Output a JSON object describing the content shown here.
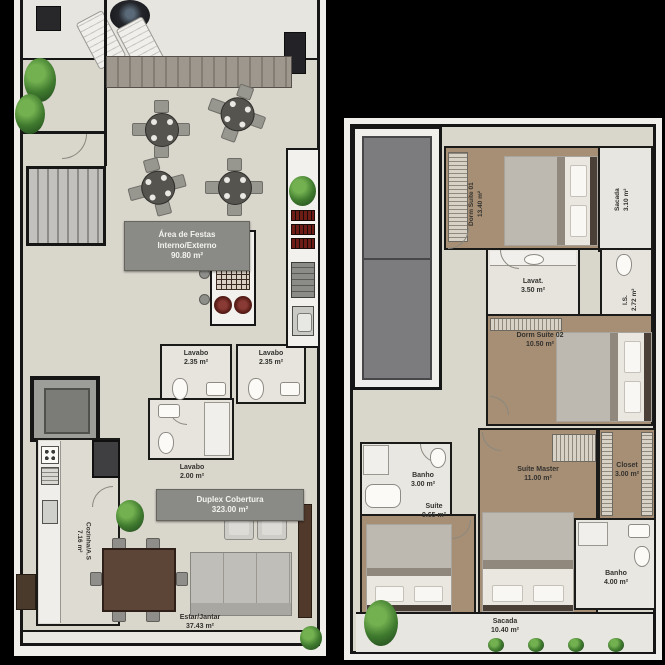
{
  "colors": {
    "background": "#000000",
    "floor_light": "#d9d6cc",
    "floor_wood": "#a78f75",
    "wall": "#1a1a19",
    "label_box": "#8a8a87",
    "plant_green": "#3f7a2e",
    "accent_dark_red": "#6b1d1d"
  },
  "left_plan": {
    "area_festas_box": {
      "line1": "Área de Festas",
      "line2": "Interno/Externo",
      "line3": "90.80 m²"
    },
    "duplex_box": {
      "line1": "Duplex Cobertura",
      "line2": "323.00 m²"
    },
    "rooms": {
      "lavabo_a": {
        "name": "Lavabo",
        "area": "2.35 m²"
      },
      "lavabo_b": {
        "name": "Lavabo",
        "area": "2.35 m²"
      },
      "lavabo_c": {
        "name": "Lavabo",
        "area": "2.00 m²"
      },
      "cozinha": {
        "name": "Cozinha/A.S",
        "area": "7.16 m²"
      },
      "estar_jantar": {
        "name": "Estar/Jantar",
        "area": "37.43 m²"
      }
    }
  },
  "right_plan": {
    "rooms": {
      "dorm_suite_01": {
        "name": "Dorm Suíte 01",
        "area": "13.40 m²"
      },
      "sacada_superior": {
        "name": "Sacada",
        "area": "3.10 m²"
      },
      "lavat": {
        "name": "Lavat.",
        "area": "3.50 m²"
      },
      "is": {
        "name": "I.S.",
        "area": "2.72 m²"
      },
      "dorm_suite_02": {
        "name": "Dorm Suíte 02",
        "area": "10.50 m²"
      },
      "banho_1": {
        "name": "Banho",
        "area": "3.00 m²"
      },
      "suite": {
        "name": "Suíte",
        "area": "9.65 m²"
      },
      "suite_master": {
        "name": "Suíte Master",
        "area": "11.00 m²"
      },
      "closet": {
        "name": "Closet",
        "area": "3.00 m²"
      },
      "banho_2": {
        "name": "Banho",
        "area": "4.00 m²"
      },
      "sacada_inferior": {
        "name": "Sacada",
        "area": "10.40 m²"
      }
    }
  }
}
